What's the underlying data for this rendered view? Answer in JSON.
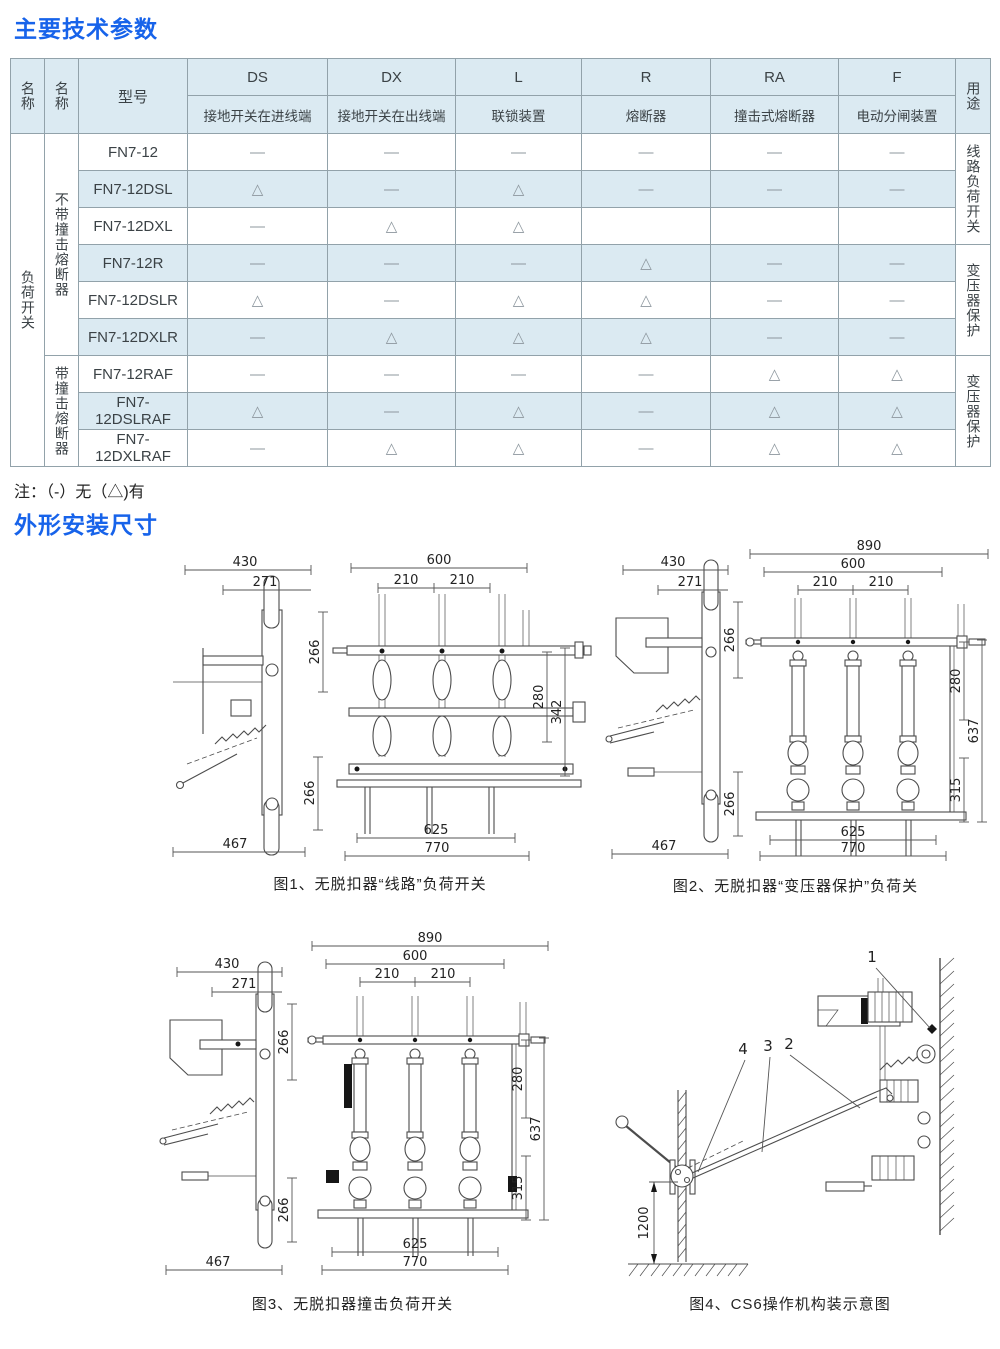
{
  "titles": {
    "params": "主要技术参数",
    "dimensions": "外形安装尺寸"
  },
  "note": "注：（-）无（△)有",
  "table": {
    "header": {
      "name1": "名称",
      "name2": "名称",
      "model": "型号",
      "use": "用途",
      "cols": [
        {
          "code": "DS",
          "desc": "接地开关在进线端"
        },
        {
          "code": "DX",
          "desc": "接地开关在出线端"
        },
        {
          "code": "L",
          "desc": "联锁装置"
        },
        {
          "code": "R",
          "desc": "熔断器"
        },
        {
          "code": "RA",
          "desc": "撞击式熔断器"
        },
        {
          "code": "F",
          "desc": "电动分闸装置"
        }
      ]
    },
    "category": "负荷开关",
    "groups": [
      {
        "label": "不带撞击熔断器"
      },
      {
        "label": "带撞击熔断器"
      }
    ],
    "uses": [
      "线路负荷开关",
      "变压器保护",
      "变压器保护"
    ],
    "rows": [
      {
        "model": "FN7-12",
        "v": [
          "—",
          "—",
          "—",
          "—",
          "—",
          "—"
        ]
      },
      {
        "model": "FN7-12DSL",
        "v": [
          "△",
          "—",
          "△",
          "—",
          "—",
          "—"
        ]
      },
      {
        "model": "FN7-12DXL",
        "v": [
          "—",
          "△",
          "△",
          "",
          "",
          ""
        ]
      },
      {
        "model": "FN7-12R",
        "v": [
          "—",
          "—",
          "—",
          "△",
          "—",
          "—"
        ]
      },
      {
        "model": "FN7-12DSLR",
        "v": [
          "△",
          "—",
          "△",
          "△",
          "—",
          "—"
        ]
      },
      {
        "model": "FN7-12DXLR",
        "v": [
          "—",
          "△",
          "△",
          "△",
          "—",
          "—"
        ]
      },
      {
        "model": "FN7-12RAF",
        "v": [
          "—",
          "—",
          "—",
          "—",
          "△",
          "△"
        ]
      },
      {
        "model": "FN7-12DSLRAF",
        "v": [
          "△",
          "—",
          "△",
          "—",
          "△",
          "△"
        ]
      },
      {
        "model": "FN7-12DXLRAF",
        "v": [
          "—",
          "△",
          "△",
          "—",
          "△",
          "△"
        ]
      }
    ]
  },
  "figures": {
    "fig1": {
      "caption": "图1、无脱扣器“线路”负荷开关",
      "d430": "430",
      "d271": "271",
      "d266a": "266",
      "d266b": "266",
      "d467": "467",
      "d600": "600",
      "d210a": "210",
      "d210b": "210",
      "d280": "280",
      "d342": "342",
      "d625": "625",
      "d770": "770"
    },
    "fig2": {
      "caption": "图2、无脱扣器“变压器保护”负荷关",
      "d430": "430",
      "d271": "271",
      "d266a": "266",
      "d266b": "266",
      "d467": "467",
      "d890": "890",
      "d600": "600",
      "d210a": "210",
      "d210b": "210",
      "d280": "280",
      "d637": "637",
      "d315": "315",
      "d625": "625",
      "d770": "770"
    },
    "fig3": {
      "caption": "图3、无脱扣器撞击负荷开关",
      "d430": "430",
      "d271": "271",
      "d266a": "266",
      "d266b": "266",
      "d467": "467",
      "d890": "890",
      "d600": "600",
      "d210a": "210",
      "d210b": "210",
      "d280": "280",
      "d637": "637",
      "d315": "315",
      "d625": "625",
      "d770": "770"
    },
    "fig4": {
      "caption": "图4、CS6操作机构装示意图",
      "n1": "1",
      "n2": "2",
      "n3": "3",
      "n4": "4",
      "d1200": "1200"
    }
  },
  "colors": {
    "accent_blue": "#1763ea",
    "table_fill": "#dbeaf2",
    "border": "#92a2aa"
  }
}
